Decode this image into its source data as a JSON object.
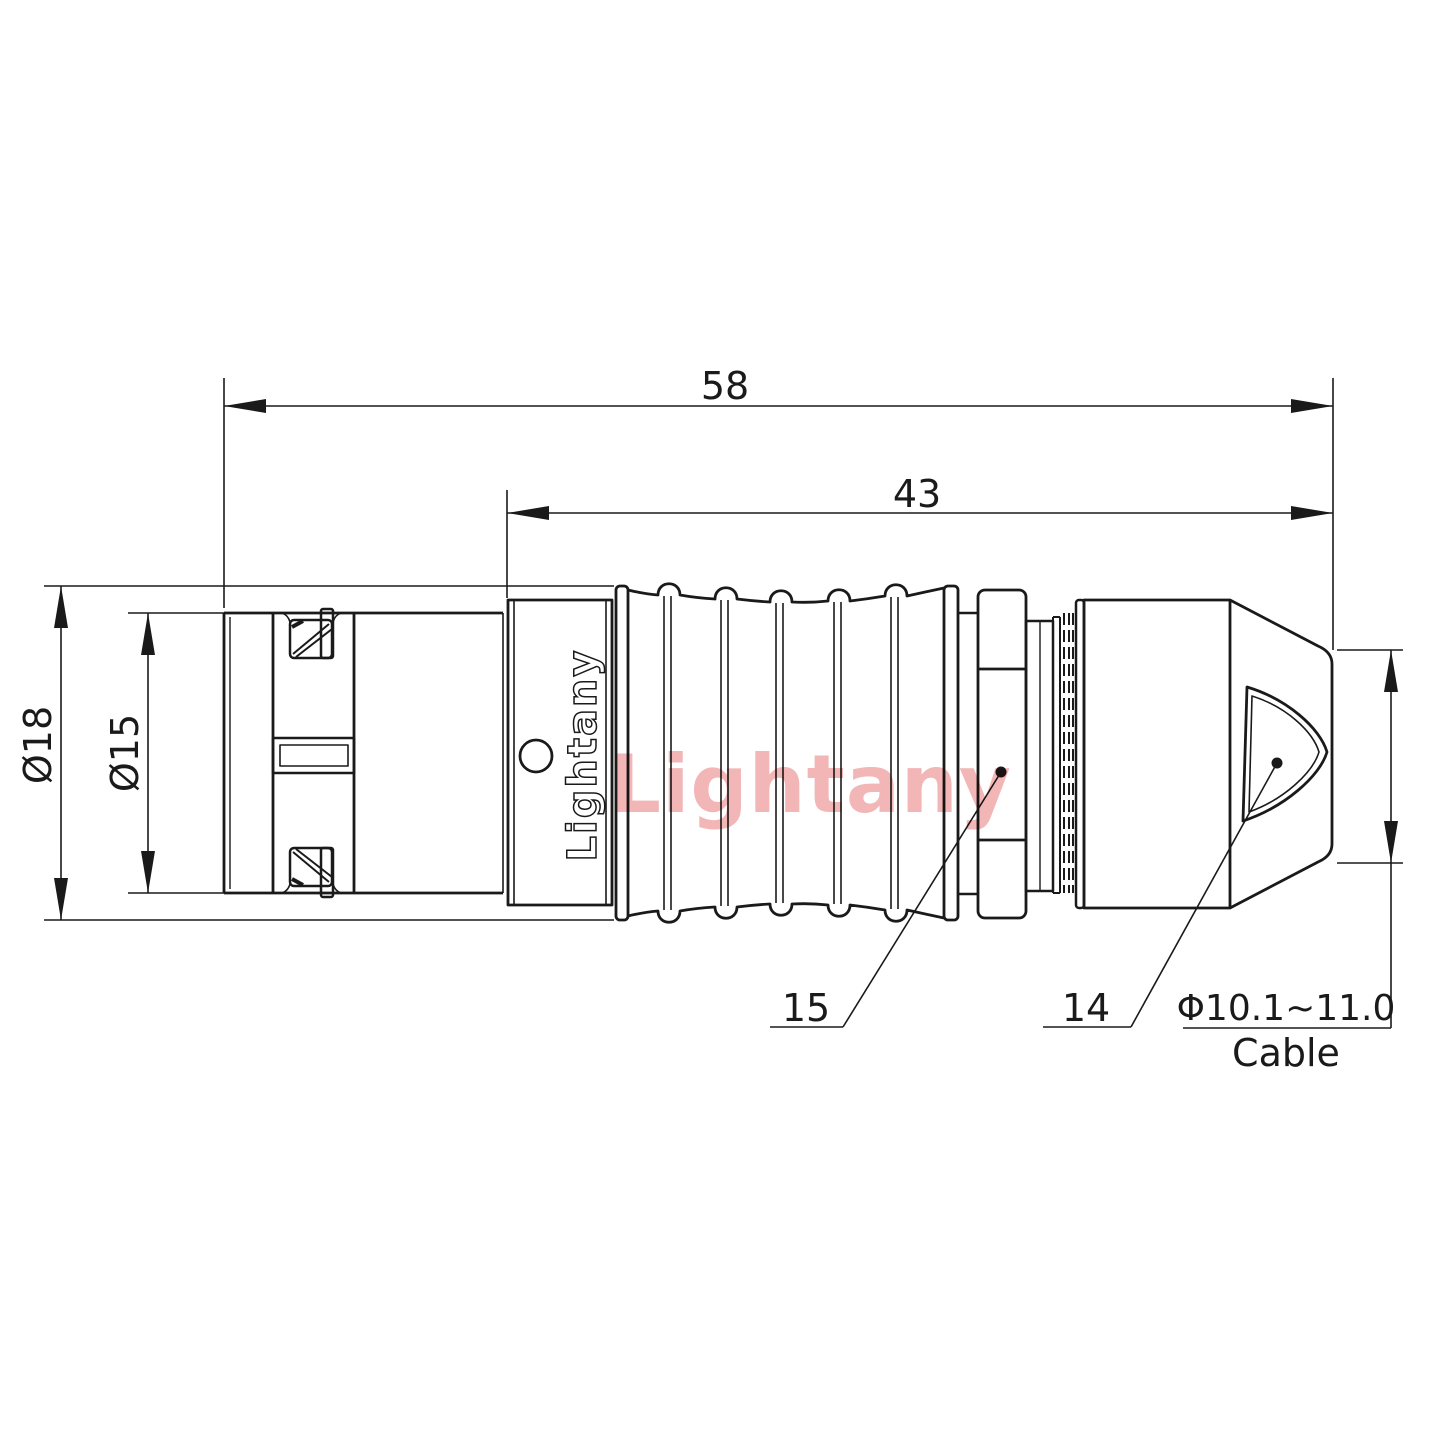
{
  "drawing": {
    "dimensions": {
      "overall_length": "58",
      "body_length": "43",
      "outer_diameter": "Ø18",
      "inner_diameter": "Ø15",
      "cable_range": "Φ10.1~11.0",
      "cable_label": "Cable",
      "part_nut": "15",
      "part_boot": "14"
    },
    "branding": {
      "logo_text": "Lightany",
      "watermark_text": "Lightany"
    },
    "colors": {
      "line": "#1a1a1a",
      "background": "#ffffff",
      "watermark": "#f2b6b6"
    }
  }
}
